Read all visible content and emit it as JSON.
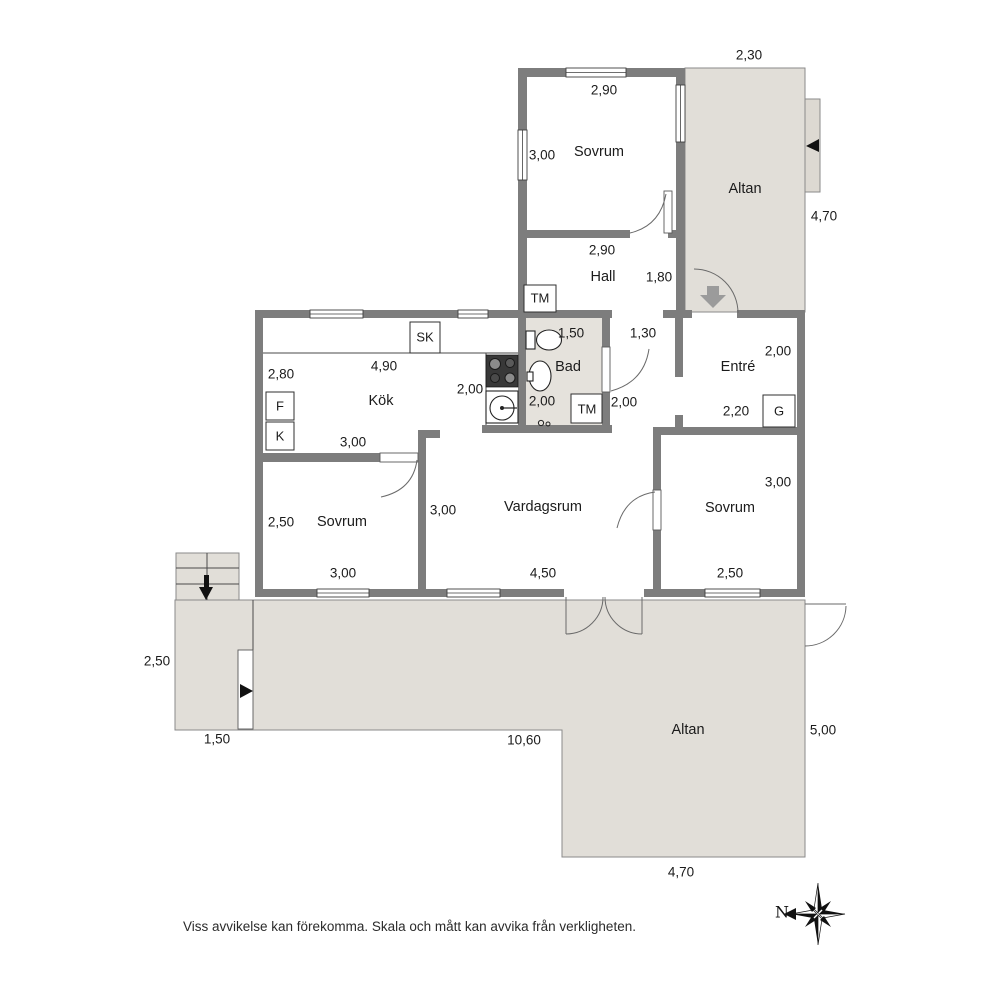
{
  "footer": {
    "disclaimer": "Viss avvikelse kan förekomma. Skala och mått kan avvika från verkligheten."
  },
  "compass": {
    "north_label": "N"
  },
  "colors": {
    "wall": "#7d7d7d",
    "altan_floor": "#e1ded8",
    "bad_floor": "#e5e2dc",
    "bench": "#ddd9d2",
    "text": "#1b1b1b"
  },
  "labels": [
    {
      "kind": "room",
      "name": "room-label-sovrum-top",
      "text": "Sovrum",
      "x": 599,
      "y": 152
    },
    {
      "kind": "room",
      "name": "room-label-altan-top",
      "text": "Altan",
      "x": 745,
      "y": 189
    },
    {
      "kind": "room",
      "name": "room-label-hall",
      "text": "Hall",
      "x": 603,
      "y": 277
    },
    {
      "kind": "room",
      "name": "room-label-bad",
      "text": "Bad",
      "x": 568,
      "y": 367
    },
    {
      "kind": "room",
      "name": "room-label-entre",
      "text": "Entré",
      "x": 738,
      "y": 367
    },
    {
      "kind": "room",
      "name": "room-label-kok",
      "text": "Kök",
      "x": 381,
      "y": 401
    },
    {
      "kind": "room",
      "name": "room-label-sovrum-left",
      "text": "Sovrum",
      "x": 342,
      "y": 522
    },
    {
      "kind": "room",
      "name": "room-label-vardagsrum",
      "text": "Vardagsrum",
      "x": 543,
      "y": 507
    },
    {
      "kind": "room",
      "name": "room-label-sovrum-right",
      "text": "Sovrum",
      "x": 730,
      "y": 508
    },
    {
      "kind": "room",
      "name": "room-label-altan-bottom",
      "text": "Altan",
      "x": 688,
      "y": 730
    },
    {
      "kind": "dim",
      "name": "dim-altan-top-width",
      "text": "2,30",
      "x": 749,
      "y": 55
    },
    {
      "kind": "dim",
      "name": "dim-sovrum-top-width",
      "text": "2,90",
      "x": 604,
      "y": 90
    },
    {
      "kind": "dim",
      "name": "dim-sovrum-top-depth",
      "text": "3,00",
      "x": 542,
      "y": 155
    },
    {
      "kind": "dim",
      "name": "dim-altan-top-depth",
      "text": "4,70",
      "x": 824,
      "y": 216
    },
    {
      "kind": "dim",
      "name": "dim-hall-width",
      "text": "2,90",
      "x": 602,
      "y": 250
    },
    {
      "kind": "dim",
      "name": "dim-hall-depth",
      "text": "1,80",
      "x": 659,
      "y": 277
    },
    {
      "kind": "dim",
      "name": "dim-bad-width",
      "text": "1,50",
      "x": 571,
      "y": 333
    },
    {
      "kind": "dim",
      "name": "dim-passage-width",
      "text": "1,30",
      "x": 643,
      "y": 333
    },
    {
      "kind": "dim",
      "name": "dim-entre-depth",
      "text": "2,00",
      "x": 778,
      "y": 351
    },
    {
      "kind": "dim",
      "name": "dim-kok-width",
      "text": "4,90",
      "x": 384,
      "y": 366
    },
    {
      "kind": "dim",
      "name": "dim-kok-depth",
      "text": "2,80",
      "x": 281,
      "y": 374
    },
    {
      "kind": "dim",
      "name": "dim-kok-counter",
      "text": "2,00",
      "x": 470,
      "y": 389
    },
    {
      "kind": "dim",
      "name": "dim-bad-depth",
      "text": "2,00",
      "x": 542,
      "y": 401
    },
    {
      "kind": "dim",
      "name": "dim-passage-depth",
      "text": "2,00",
      "x": 624,
      "y": 402
    },
    {
      "kind": "dim",
      "name": "dim-entre-width",
      "text": "2,20",
      "x": 736,
      "y": 411
    },
    {
      "kind": "dim",
      "name": "dim-kok-lower-width",
      "text": "3,00",
      "x": 353,
      "y": 442
    },
    {
      "kind": "dim",
      "name": "dim-sovrum-right-depth",
      "text": "3,00",
      "x": 778,
      "y": 482
    },
    {
      "kind": "dim",
      "name": "dim-vardagsrum-depth",
      "text": "3,00",
      "x": 443,
      "y": 510
    },
    {
      "kind": "dim",
      "name": "dim-sovrum-left-depth",
      "text": "2,50",
      "x": 281,
      "y": 522
    },
    {
      "kind": "dim",
      "name": "dim-sovrum-left-width",
      "text": "3,00",
      "x": 343,
      "y": 573
    },
    {
      "kind": "dim",
      "name": "dim-vardagsrum-width",
      "text": "4,50",
      "x": 543,
      "y": 573
    },
    {
      "kind": "dim",
      "name": "dim-sovrum-right-width",
      "text": "2,50",
      "x": 730,
      "y": 573
    },
    {
      "kind": "dim",
      "name": "dim-altan-left-depth",
      "text": "2,50",
      "x": 157,
      "y": 661
    },
    {
      "kind": "dim",
      "name": "dim-altan-left-width",
      "text": "1,50",
      "x": 217,
      "y": 739
    },
    {
      "kind": "dim",
      "name": "dim-altan-strip-width",
      "text": "10,60",
      "x": 524,
      "y": 740
    },
    {
      "kind": "dim",
      "name": "dim-altan-bottom-depth",
      "text": "5,00",
      "x": 823,
      "y": 730
    },
    {
      "kind": "dim",
      "name": "dim-altan-bottom-width",
      "text": "4,70",
      "x": 681,
      "y": 872
    },
    {
      "kind": "fixture",
      "name": "label-sk-closet",
      "text": "SK",
      "x": 425,
      "y": 337
    },
    {
      "kind": "fixture",
      "name": "label-tm-hall",
      "text": "TM",
      "x": 540,
      "y": 298
    },
    {
      "kind": "fixture",
      "name": "label-tm-bad",
      "text": "TM",
      "x": 587,
      "y": 409
    },
    {
      "kind": "fixture",
      "name": "label-f-appliance",
      "text": "F",
      "x": 280,
      "y": 406
    },
    {
      "kind": "fixture",
      "name": "label-k-appliance",
      "text": "K",
      "x": 280,
      "y": 436
    },
    {
      "kind": "fixture",
      "name": "label-g-closet",
      "text": "G",
      "x": 779,
      "y": 411
    }
  ]
}
